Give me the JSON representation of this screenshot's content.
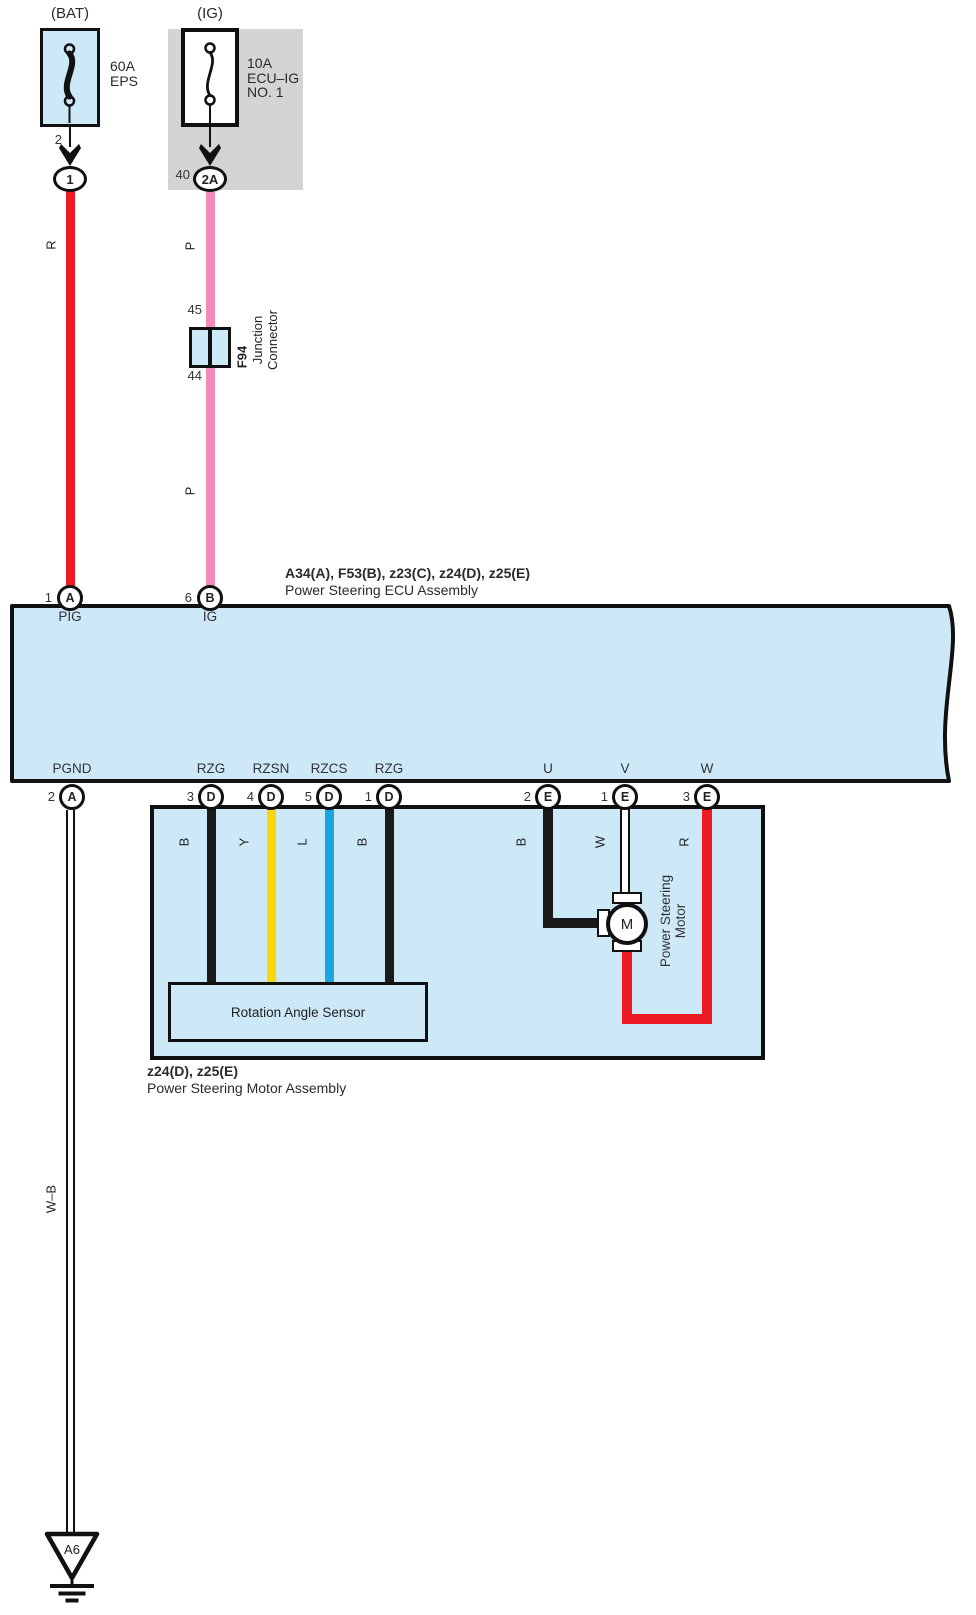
{
  "colors": {
    "panel_blue": "#cde9f7",
    "panel_gray": "#d4d4d4",
    "wire_red": "#ed1c24",
    "wire_pink": "#f18bbb",
    "wire_yellow": "#fbd707",
    "wire_blue": "#1ca6e0",
    "wire_black": "#1a1a1a",
    "wire_white": "#ffffff",
    "outline": "#111111"
  },
  "bat": {
    "title": "(BAT)",
    "fuse_rating": "60A",
    "fuse_name": "EPS",
    "pin_top": "2",
    "connector": "1",
    "wire_color_label": "R"
  },
  "ig": {
    "title": "(IG)",
    "fuse_rating": "10A",
    "fuse_name_line1": "ECU–IG",
    "fuse_name_line2": "NO. 1",
    "pin_top": "40",
    "connector": "2A",
    "wire_color_label": "P"
  },
  "junction": {
    "pin_top": "45",
    "pin_bottom": "44",
    "id": "F94",
    "name_line1": "Junction",
    "name_line2": "Connector"
  },
  "ecu": {
    "code_line": "A34(A), F53(B), z23(C), z24(D), z25(E)",
    "name": "Power Steering ECU Assembly",
    "top_pins": [
      {
        "num": "1",
        "conn": "A",
        "port": "PIG"
      },
      {
        "num": "6",
        "conn": "B",
        "port": "IG"
      }
    ],
    "bottom_pins": [
      {
        "num": "2",
        "conn": "A",
        "port": "PGND"
      },
      {
        "num": "3",
        "conn": "D",
        "port": "RZG"
      },
      {
        "num": "4",
        "conn": "D",
        "port": "RZSN"
      },
      {
        "num": "5",
        "conn": "D",
        "port": "RZCS"
      },
      {
        "num": "1",
        "conn": "D",
        "port": "RZG"
      },
      {
        "num": "2",
        "conn": "E",
        "port": "U"
      },
      {
        "num": "1",
        "conn": "E",
        "port": "V"
      },
      {
        "num": "3",
        "conn": "E",
        "port": "W"
      }
    ]
  },
  "motor_assembly": {
    "code_line": "z24(D), z25(E)",
    "name": "Power Steering Motor Assembly",
    "sensor_label": "Rotation Angle Sensor",
    "motor_label_line1": "Power Steering",
    "motor_label_line2": "Motor",
    "motor_symbol": "M",
    "wire_labels": [
      "B",
      "Y",
      "L",
      "B",
      "B",
      "W",
      "R"
    ]
  },
  "ground": {
    "wire_label": "W–B",
    "id": "A6"
  }
}
